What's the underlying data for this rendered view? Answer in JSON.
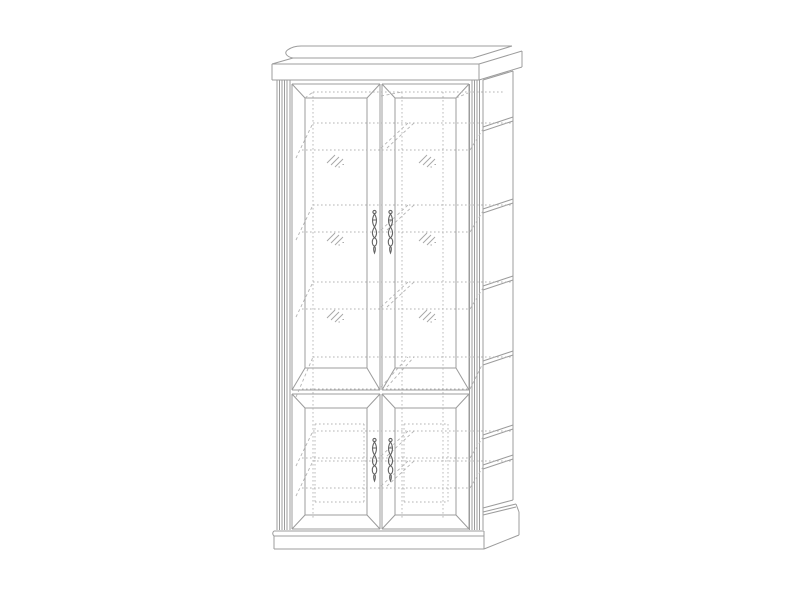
{
  "canvas": {
    "width": 801,
    "height": 600,
    "background": "#ffffff"
  },
  "colors": {
    "background": "#ffffff",
    "outline": "#9c9c9c",
    "hidden": "#b4b4b4",
    "hatch": "#a6a6a6",
    "handle": "#636363"
  },
  "drawing": {
    "kind": "furniture wireframe line drawing",
    "item": "two-section display cabinet (vitrine) with four doors",
    "view": "front view with depth receding to the upper right",
    "upper_doors": {
      "count": 2,
      "style": "glazed doors with beveled mitered frames",
      "glass_hatch_marks_per_door": 3
    },
    "lower_doors": {
      "count": 2,
      "style": "solid doors with beveled mitered frames and inset panel field"
    },
    "handles": {
      "count": 4,
      "style": "vertical ornate drop handles at the center stiles"
    },
    "shelves": {
      "upper_section": 3,
      "middle_fixed": 1,
      "lower_section": 2,
      "rendering": "hidden dotted lines with shelf edges visible on right side"
    },
    "cornice": "crown molding top with ogee profile",
    "base": "plinth with molded top edge",
    "pilasters": "fluted pilasters on left and right front corners"
  }
}
